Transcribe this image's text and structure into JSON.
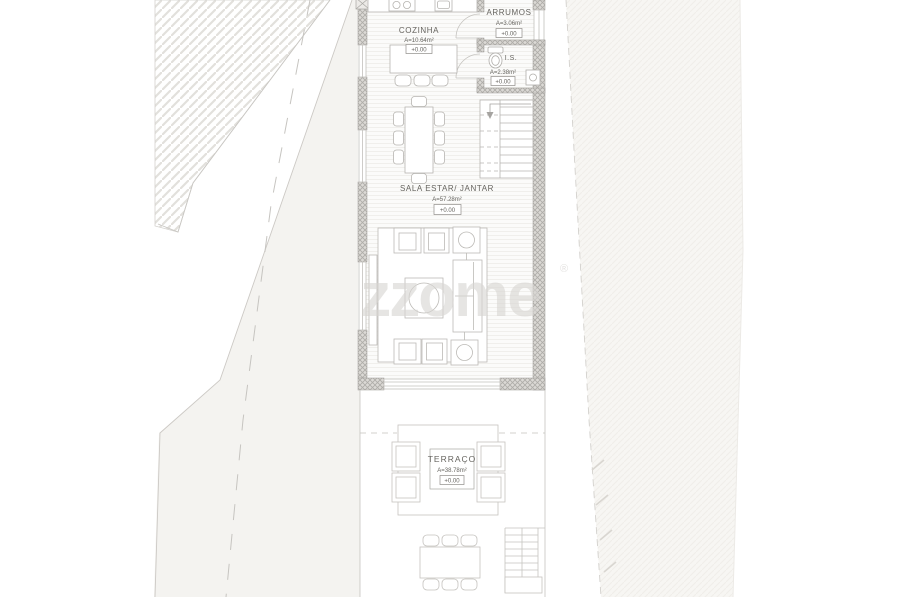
{
  "watermark": {
    "text": "zzome",
    "registered": "®"
  },
  "rooms": {
    "cozinha": {
      "name": "COZINHA",
      "area": "A=10.64m²",
      "level": "+0.00"
    },
    "arrumos": {
      "name": "ARRUMOS",
      "area": "A=3.06m²",
      "level": "+0.00"
    },
    "is": {
      "name": "I.S.",
      "area": "A=2.38m²",
      "level": "+0.00"
    },
    "sala": {
      "name": "SALA ESTAR/ JANTAR",
      "area": "A=57.28m²",
      "level": "+0.00"
    },
    "terraco": {
      "name": "TERRAÇO",
      "area": "A=38.78m²",
      "level": "+0.00"
    }
  },
  "colors": {
    "background": "#ffffff",
    "site_fill": "#f4f3f0",
    "plan_line": "#b7b5b1",
    "wall_fill": "#dbd9d5",
    "wall_hatch": "#aeaca8",
    "parcel_hatch": "#e2e0dc",
    "text": "#66645f",
    "watermark": "#d8d6d3"
  }
}
